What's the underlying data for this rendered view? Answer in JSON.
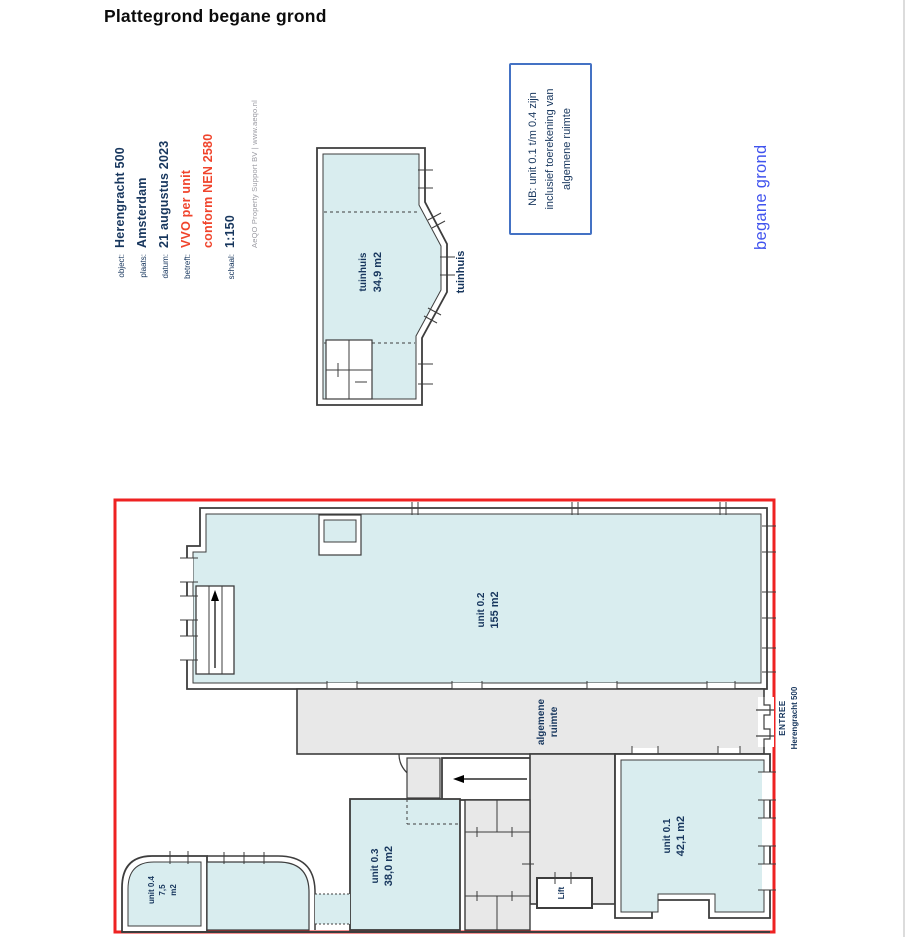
{
  "title": "Plattegrond begane grond",
  "meta": {
    "rows": [
      {
        "label": "object:",
        "value": "Herengracht 500"
      },
      {
        "label": "plaats:",
        "value": "Amsterdam"
      },
      {
        "label": "datum:",
        "value": "21 augustus 2023"
      },
      {
        "label": "betreft:",
        "value": "VVO per unit"
      },
      {
        "label": "",
        "value": "conform NEN 2580"
      },
      {
        "label": "schaal:",
        "value": "1:150"
      }
    ],
    "credit": "AeQO Property Support BV | www.aeqo.nl"
  },
  "note": {
    "lines": [
      "NB: unit 0.1 t/m 0.4 zijn",
      "inclusief toerekening van",
      "algemene ruimte"
    ]
  },
  "floor_label": "begane grond",
  "garden_plan": {
    "room_name": "tuinhuis",
    "room_area": "34,9 m2",
    "outside_label": "tuinhuis"
  },
  "main_plan": {
    "unit02": {
      "name": "unit 0.2",
      "area": "155 m2"
    },
    "unit01": {
      "name": "unit 0.1",
      "area": "42,1 m2"
    },
    "unit03": {
      "name": "unit 0.3",
      "area": "38,0 m2"
    },
    "unit04": {
      "name": "unit 0.4",
      "area": "7,5",
      "area_unit": "m2"
    },
    "common_room": {
      "line1": "algemene",
      "line2": "ruimte"
    },
    "lift": "Lift",
    "entree": {
      "line1": "ENTREE",
      "line2": "Herengracht 500"
    }
  },
  "colors": {
    "unit_fill": "#d9edef",
    "common_fill": "#e8e8e8",
    "wall": "#3d3d3d",
    "outline_red": "#ee2222",
    "accent_blue": "#4053ee",
    "note_border": "#4472c4",
    "text_navy": "#17365d",
    "text_red": "#f0442c"
  }
}
